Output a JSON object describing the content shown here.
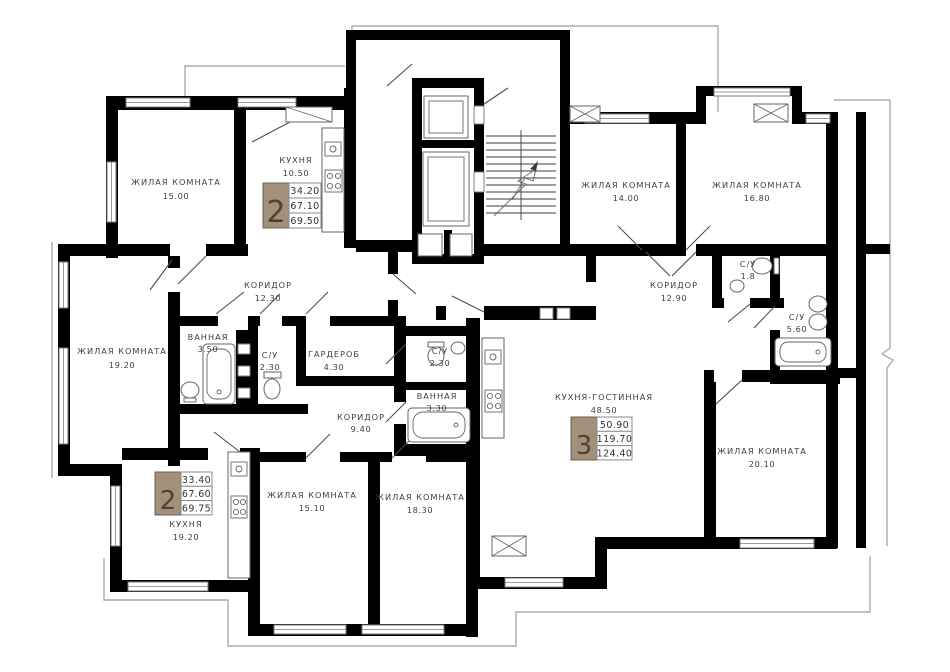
{
  "floor_plan": {
    "colors": {
      "wall": "#000000",
      "badge_fill": "#a3907a",
      "badge_border": "#6e6051",
      "label_text": "#3f3f3f",
      "outline": "#ababab"
    },
    "rooms": [
      {
        "id": "room-a1",
        "name": "ЖИЛАЯ КОМНАТА",
        "area": "15.00"
      },
      {
        "id": "kitchen-a",
        "name": "КУХНЯ",
        "area": "10.50"
      },
      {
        "id": "corridor-a",
        "name": "КОРИДОР",
        "area": "12.30"
      },
      {
        "id": "room-a2",
        "name": "ЖИЛАЯ КОМНАТА",
        "area": "19.20"
      },
      {
        "id": "bath-a",
        "name": "ВАННАЯ",
        "area": "3.50"
      },
      {
        "id": "wc-a",
        "name": "С/У",
        "area": "2.30"
      },
      {
        "id": "wardrobe-a",
        "name": "ГАРДЕРОБ",
        "area": "4.30"
      },
      {
        "id": "corridor-b",
        "name": "КОРИДОР",
        "area": "9.40"
      },
      {
        "id": "wc-b",
        "name": "С/У",
        "area": "2.30"
      },
      {
        "id": "bath-b",
        "name": "ВАННАЯ",
        "area": "3.30"
      },
      {
        "id": "kitchen-b",
        "name": "КУХНЯ",
        "area": "19.20"
      },
      {
        "id": "room-b1",
        "name": "ЖИЛАЯ КОМНАТА",
        "area": "15.10"
      },
      {
        "id": "room-b2",
        "name": "ЖИЛАЯ КОМНАТА",
        "area": "18.30"
      },
      {
        "id": "living-c",
        "name": "КУХНЯ-ГОСТИННАЯ",
        "area": "48.50"
      },
      {
        "id": "room-c1",
        "name": "ЖИЛАЯ КОМНАТА",
        "area": "14.00"
      },
      {
        "id": "room-c2",
        "name": "ЖИЛАЯ КОМНАТА",
        "area": "16.80"
      },
      {
        "id": "corridor-c",
        "name": "КОРИДОР",
        "area": "12.90"
      },
      {
        "id": "wc-c1",
        "name": "С/У",
        "area": "1.8"
      },
      {
        "id": "wc-c2",
        "name": "С/У",
        "area": "5.60"
      },
      {
        "id": "room-c3",
        "name": "ЖИЛАЯ КОМНАТА",
        "area": "20.10"
      }
    ],
    "apartments": [
      {
        "badge": "2",
        "living_area": "34.20",
        "area": "67.10",
        "total_area": "69.50"
      },
      {
        "badge": "2",
        "living_area": "33.40",
        "area": "67.60",
        "total_area": "69.75"
      },
      {
        "badge": "3",
        "living_area": "50.90",
        "area": "119.70",
        "total_area": "124.40"
      }
    ]
  }
}
